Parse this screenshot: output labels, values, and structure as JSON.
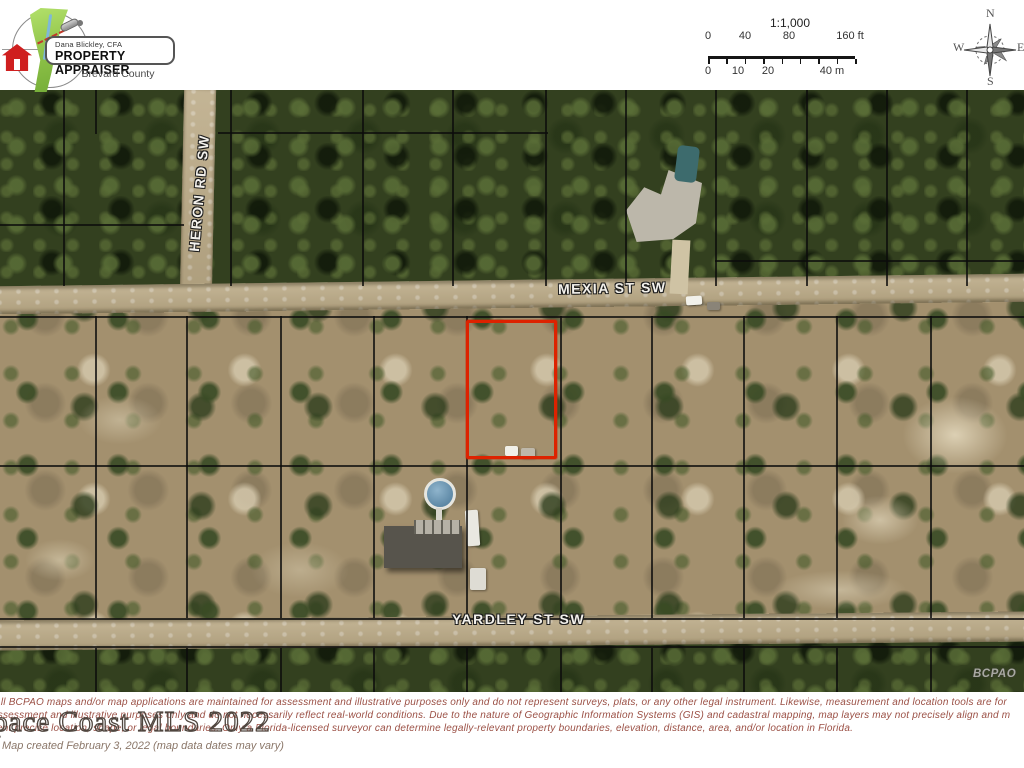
{
  "header": {
    "logo": {
      "name_line": "Dana Blickley, CFA",
      "title_line": "PROPERTY APPRAISER",
      "county_line": "Brevard County"
    },
    "scale_bar": {
      "ratio": "1:1,000",
      "ft_labels": [
        "0",
        "40",
        "80",
        "160 ft"
      ],
      "m_labels": [
        "0",
        "10",
        "20",
        "40 m"
      ]
    },
    "compass": {
      "north": "N",
      "south": "S",
      "east": "E",
      "west": "W"
    }
  },
  "map": {
    "streets": {
      "heron": "HERON RD SW",
      "mexia": "MEXIA ST SW",
      "yardley": "YARDLEY ST SW"
    },
    "corner_watermark": "BCPAO"
  },
  "footer": {
    "disclaimer_lines": [
      "All BCPAO maps and/or map applications are maintained for assessment and illustrative purposes only and do not represent surveys, plats, or any other legal instrument. Likewise, measurement and location tools are for",
      "assessment and illustrative purposes only and do not necessarily reflect real-world conditions. Due to the nature of Geographic Information Systems (GIS) and cadastral mapping, map layers may not precisely align and m",
      "not represent precise location, shape, or legal boundaries. Only a Florida-licensed surveyor can determine legally-relevant property boundaries, elevation, distance, area, and/or location in Florida."
    ],
    "mls_watermark": "Space Coast MLS 2022",
    "created_line": "Map created February 3, 2022 (map data dates may vary)"
  },
  "colors": {
    "parcel_highlight": "#dd2200",
    "disclaimer_text": "#9b5045",
    "county_shape_green": "#8cc046",
    "house_icon_red": "#cf1f1f"
  }
}
